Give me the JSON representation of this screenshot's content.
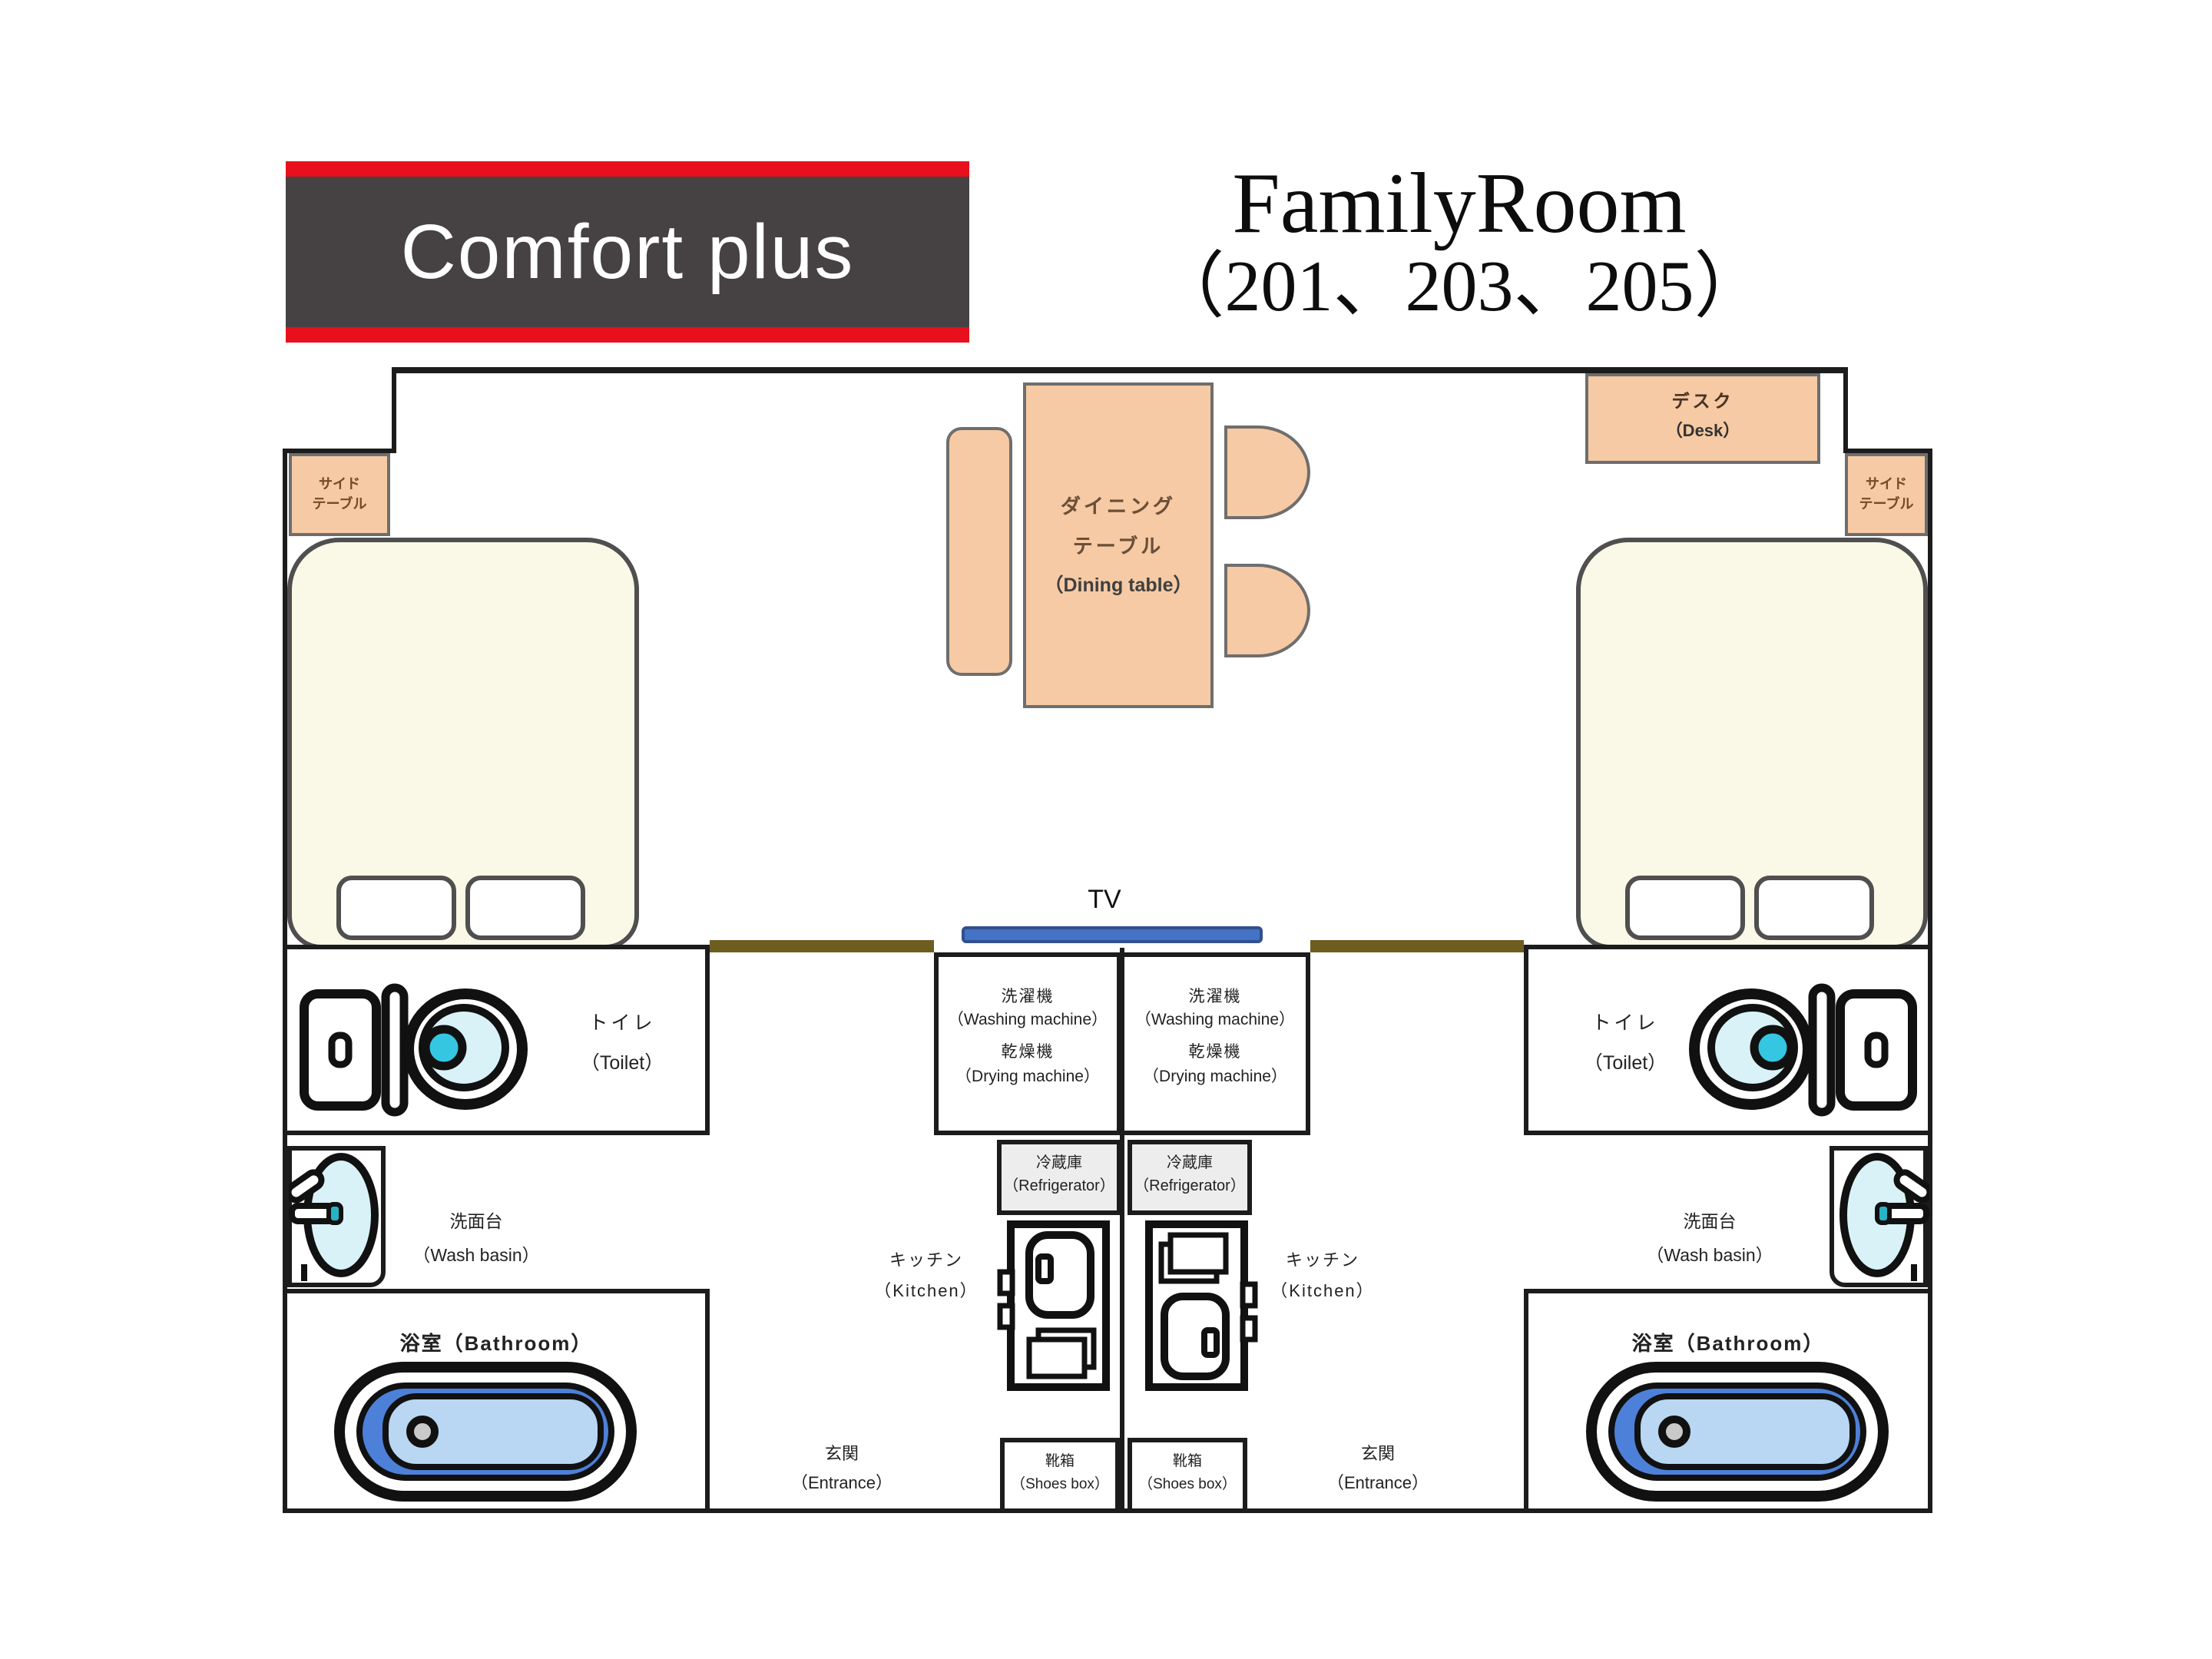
{
  "header": {
    "logo_text": "Comfort plus",
    "title_line1": "FamilyRoom",
    "title_line2": "（201、203、205）"
  },
  "labels": {
    "side_table_line1": "サイド",
    "side_table_line2": "テーブル",
    "desk_jp": "デスク",
    "desk_en": "（Desk）",
    "dining_line1": "ダイニング",
    "dining_line2": "テーブル",
    "dining_en": "（Dining table）",
    "tv": "TV",
    "washer_jp": "洗濯機",
    "washer_en": "（Washing machine）",
    "dryer_jp": "乾燥機",
    "dryer_en": "（Drying machine）",
    "fridge_jp": "冷蔵庫",
    "fridge_en": "（Refrigerator）",
    "kitchen_jp": "キッチン",
    "kitchen_en": "（Kitchen）",
    "toilet_jp": "トイレ",
    "toilet_en": "（Toilet）",
    "basin_jp": "洗面台",
    "basin_en": "（Wash basin）",
    "bathroom": "浴室（Bathroom）",
    "entrance_jp": "玄関",
    "entrance_en": "（Entrance）",
    "shoes_jp": "靴箱",
    "shoes_en": "（Shoes box）"
  },
  "colors": {
    "logo_red": "#e8101d",
    "logo_gray": "#464243",
    "furniture_peach": "#f6caa4",
    "bed_cream": "#faf8e6",
    "tv_blue": "#4472c4",
    "bathtub_blue": "#4d80d8",
    "bathtub_inner_blue": "#b9d6f2",
    "fixture_cyan": "#d9f2f8",
    "flush_cyan": "#35c6e2",
    "wall_black": "#1c1c1c",
    "wall_olive": "#6d5d1f",
    "fridge_gray": "#ededed"
  }
}
